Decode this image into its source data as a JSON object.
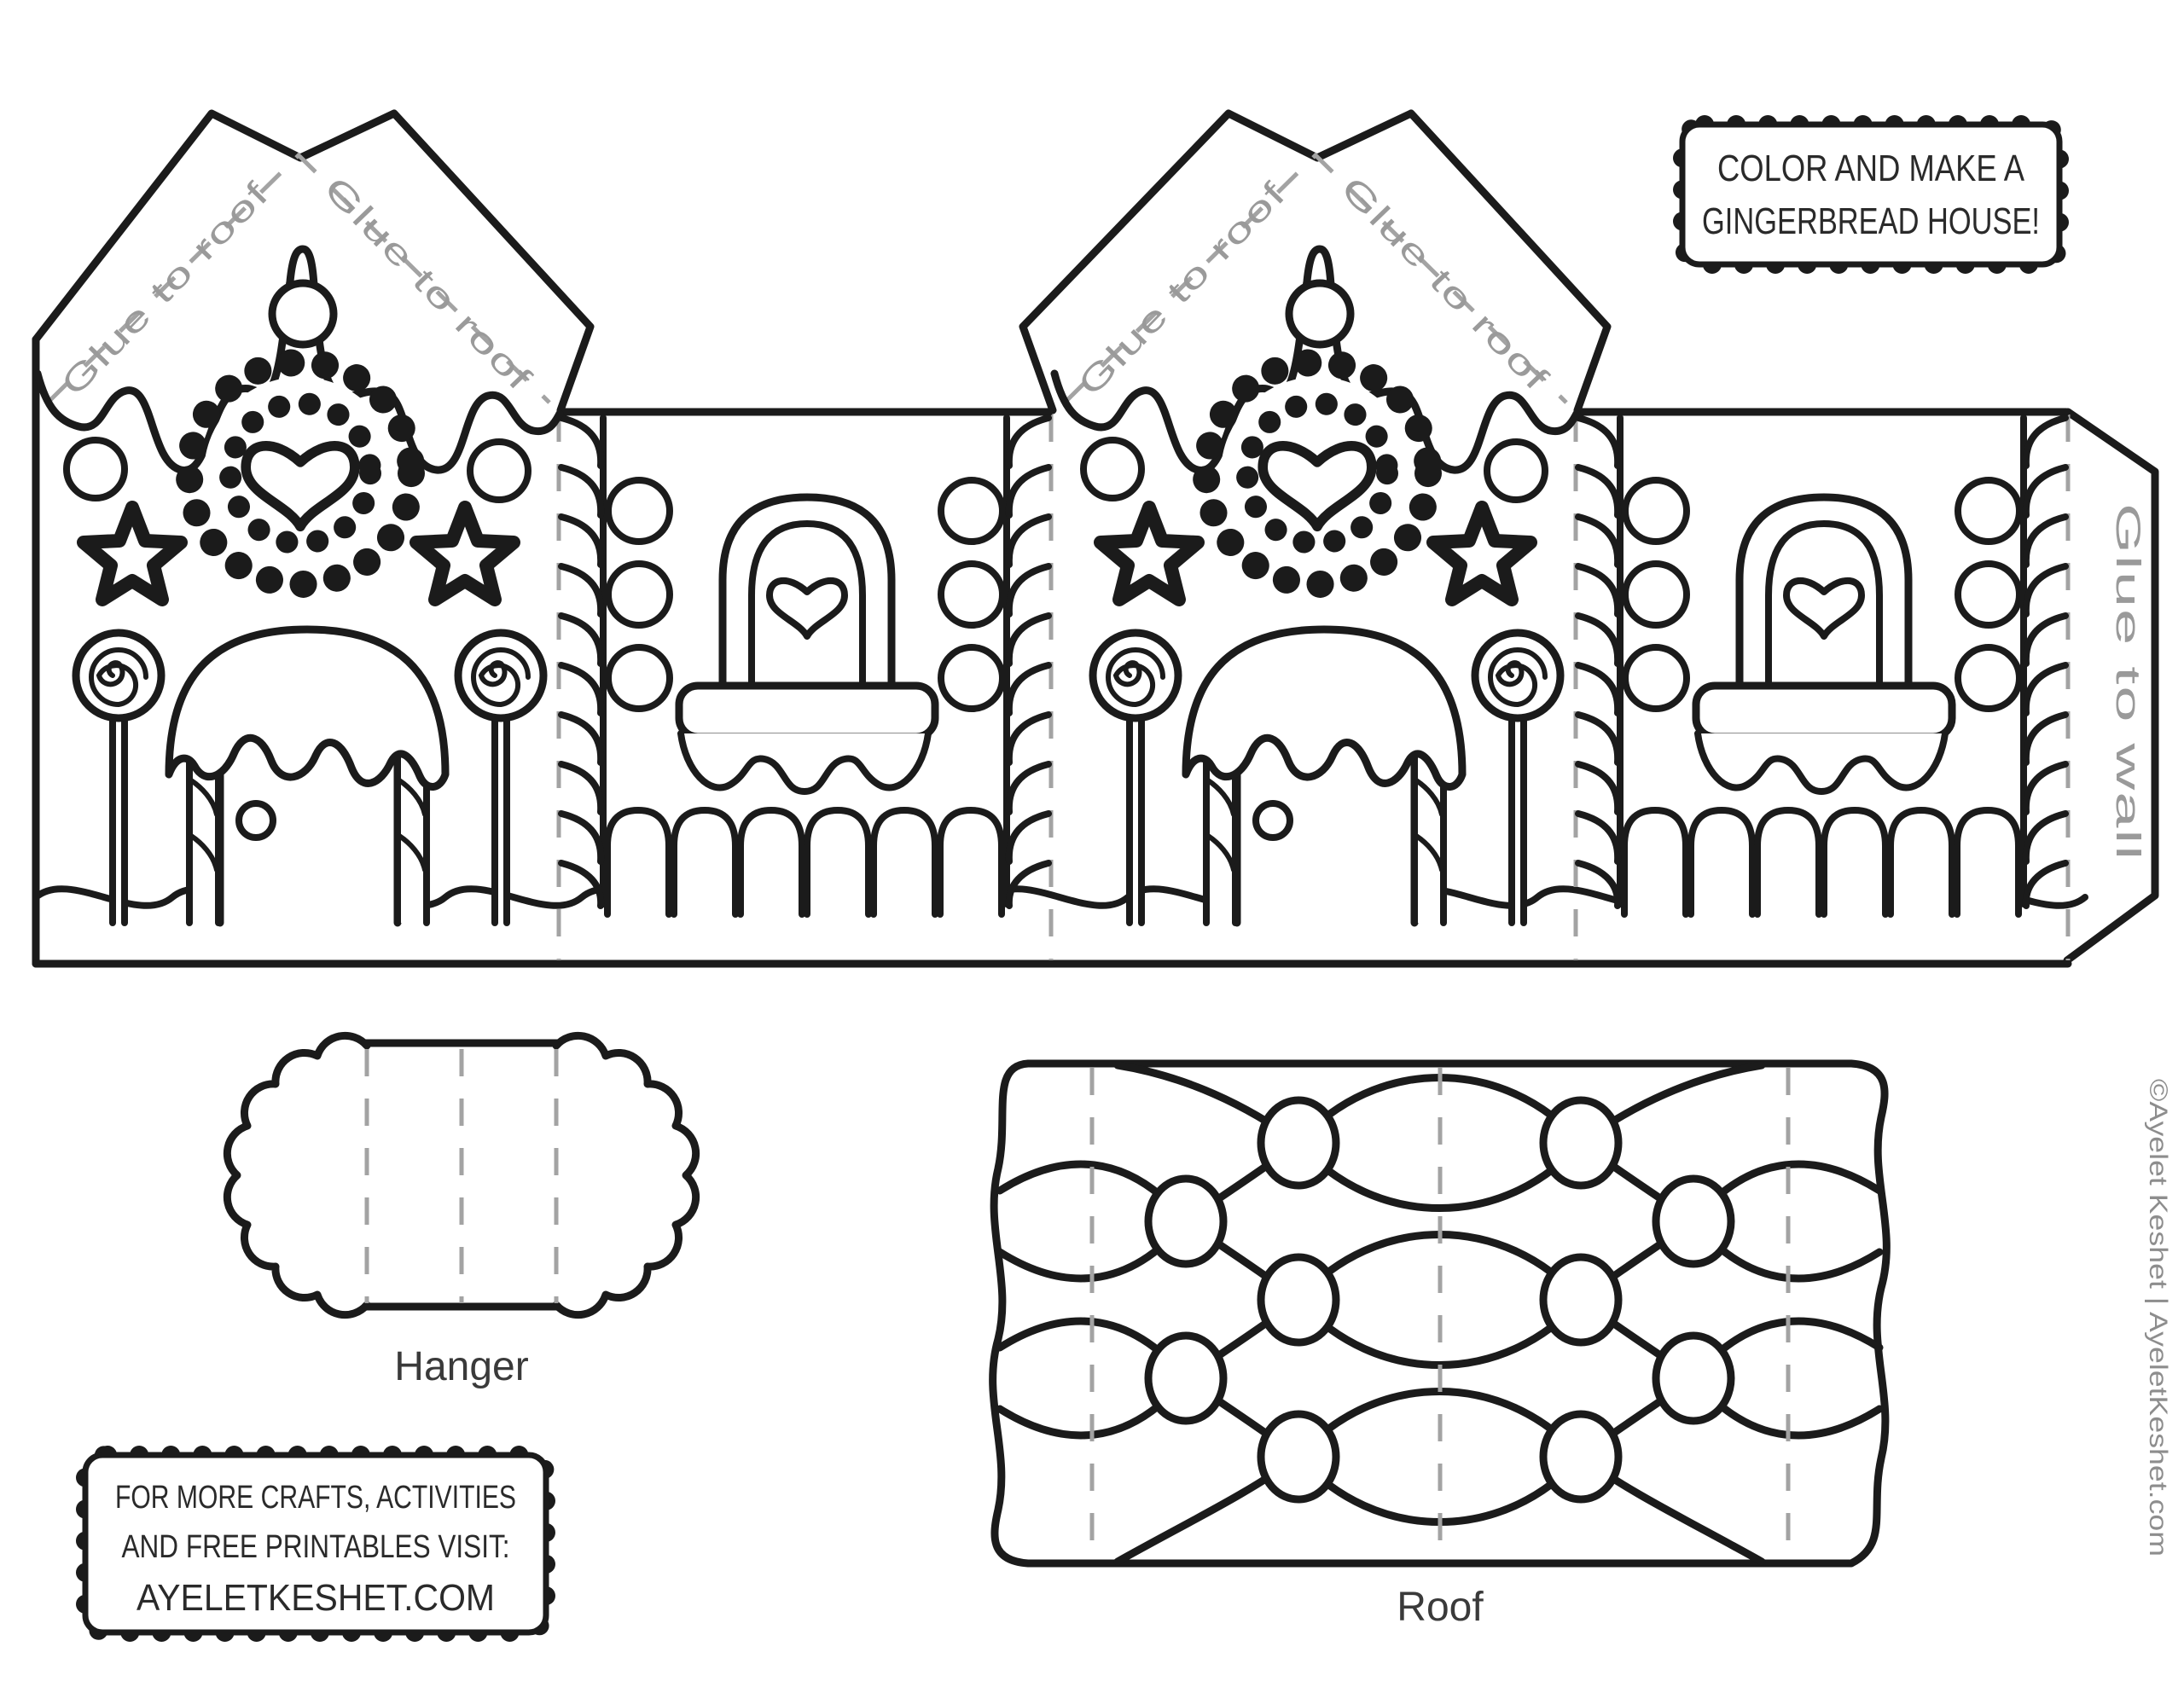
{
  "labels": {
    "glue_to_roof": "Glue to roof",
    "glue_to_wall": "Glue to wall",
    "hanger": "Hanger",
    "roof": "Roof"
  },
  "title_box": {
    "line1": "COLOR AND MAKE A",
    "line2": "GINGERBREAD HOUSE!"
  },
  "info_box": {
    "line1": "FOR MORE CRAFTS, ACTIVITIES",
    "line2": "AND FREE PRINTABLES VISIT:",
    "line3": "AYELETKESHET.COM"
  },
  "credit": "©Ayelet Keshet | AyeletKeshet.com",
  "colors": {
    "line": "#1b1b1b",
    "fold_gray": "#a3a3a3",
    "label_gray": "#9a9a9a",
    "text": "#2a2a2a"
  }
}
